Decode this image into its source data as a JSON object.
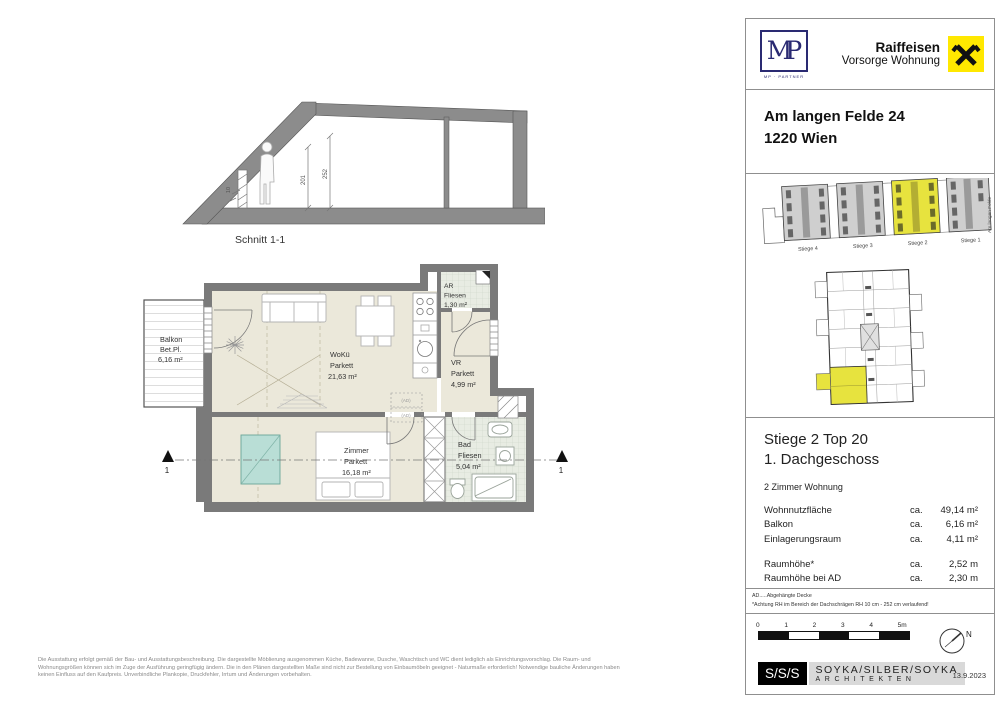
{
  "header": {
    "mp_logo": "MP",
    "mp_caption": "MP · PARTNER",
    "raiffeisen_line1": "Raiffeisen",
    "raiffeisen_line2": "Vorsorge Wohnung"
  },
  "address": {
    "line1": "Am langen Felde 24",
    "line2": "1220 Wien"
  },
  "site": {
    "stiege_labels": [
      "Stiege 4",
      "Stiege 3",
      "Stiege 2",
      "Stiege 1"
    ],
    "street_label": "Am langen Felde"
  },
  "unit_info": {
    "title_line1": "Stiege 2 Top 20",
    "title_line2": "1. Dachgeschoss",
    "subtitle": "2 Zimmer Wohnung",
    "rows": [
      {
        "label": "Wohnnutzfläche",
        "prefix": "ca.",
        "amount": "49,14 m²"
      },
      {
        "label": "Balkon",
        "prefix": "ca.",
        "amount": "6,16 m²"
      },
      {
        "label": "Einlagerungsraum",
        "prefix": "ca.",
        "amount": "4,11 m²"
      }
    ],
    "rows2": [
      {
        "label": "Raumhöhe*",
        "prefix": "ca.",
        "amount": "2,52 m"
      },
      {
        "label": "Raumhöhe bei AD",
        "prefix": "ca.",
        "amount": "2,30 m"
      }
    ],
    "footnote1": "AD.....Abgehängte Decke",
    "footnote2": "*Achtung RH im Bereich der Dachschrägen RH 10 cm - 252 cm verlaufend!"
  },
  "footer_block": {
    "scale_ticks": [
      "0",
      "1",
      "2",
      "3",
      "4",
      "5m"
    ],
    "north_label": "N",
    "logo": "S/S/S",
    "firm_line1": "SOYKA/SILBER/SOYKA",
    "firm_line2": "ARCHITEKTEN",
    "date": "13.9.2023"
  },
  "section_drawing": {
    "caption": "Schnitt 1-1",
    "dim_252": "252",
    "dim_201": "201",
    "dim_10": "10"
  },
  "plan": {
    "balkon": {
      "name": "Balkon",
      "sub": "Bet.Pl.",
      "area": "6,16 m²"
    },
    "woku": {
      "name": "WoKü",
      "sub": "Parkett",
      "area": "21,63 m²"
    },
    "ar": {
      "name": "AR",
      "sub": "Fliesen",
      "area": "1,30 m²"
    },
    "vr": {
      "name": "VR",
      "sub": "Parkett",
      "area": "4,99 m²"
    },
    "zimmer": {
      "name": "Zimmer",
      "sub": "Parkett",
      "area": "16,18 m²"
    },
    "bad": {
      "name": "Bad",
      "sub": "Fliesen",
      "area": "5,04 m²"
    },
    "ad_label": "(AD)",
    "marker": "1"
  },
  "disclaimer": {
    "line1": "Die Ausstattung erfolgt gemäß der Bau- und Ausstattungsbeschreibung. Die dargestellte Möblierung ausgenommen Küche, Badewanne, Dusche, Waschtisch und WC dient lediglich als Einrichtungsvorschlag. Die Raum- und",
    "line2": "Wohnungsgrößen können sich im Zuge der Ausführung geringfügig ändern. Die in den Plänen dargestellten Maße sind nicht zur Bestellung von Einbaumöbeln geeignet - Naturmaße erforderlich! Notwendige bauliche Änderungen haben",
    "line3": "keinen Einfluss auf den Kaufpreis. Unverbindliche Plankopie, Druckfehler, Irrtum und Änderungen vorbehalten."
  },
  "colors": {
    "wall_gray": "#7a7a7a",
    "floor_beige": "#ebe8da",
    "tile_green": "#e8ece3",
    "highlight_yellow": "#e7e33e",
    "teal": "#b9ded6",
    "raiffeisen_yellow": "#ffe800",
    "mp_navy": "#2a2a72"
  }
}
